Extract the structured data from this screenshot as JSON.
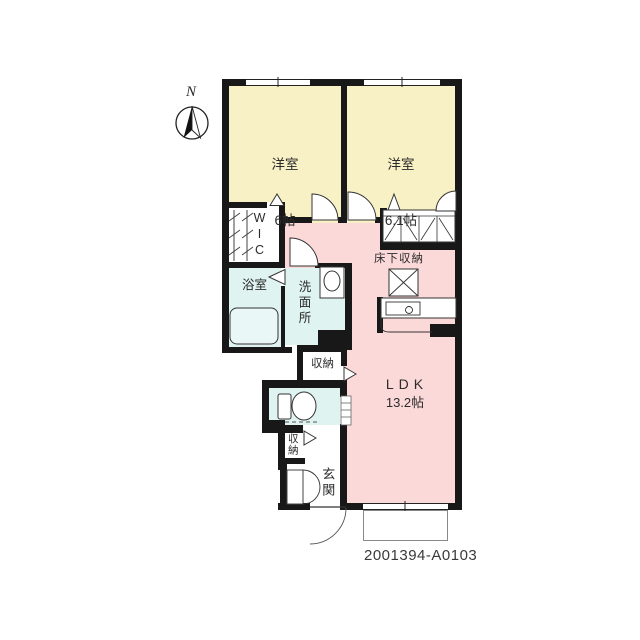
{
  "meta": {
    "code": "2001394-A0103",
    "compass_north_label": "N"
  },
  "colors": {
    "wall": "#181818",
    "bedroom_fill": "#f8f1c5",
    "ldk_fill": "#fcd9d9",
    "wet_fill": "#dff3f1",
    "background": "#ffffff"
  },
  "rooms": {
    "bedroom1": {
      "label": "洋室",
      "size": "6帖"
    },
    "bedroom2": {
      "label": "洋室",
      "size": "6.1帖"
    },
    "wic": {
      "label": "WIC"
    },
    "bath": {
      "label": "浴室"
    },
    "washroom": {
      "label": "洗面所"
    },
    "underfloor_storage": {
      "label": "床下収納"
    },
    "ldk": {
      "label": "LDK",
      "size": "13.2帖"
    },
    "storage_hall": {
      "label": "収納"
    },
    "storage_entry": {
      "label": "収納"
    },
    "entrance": {
      "label": "玄関"
    }
  }
}
